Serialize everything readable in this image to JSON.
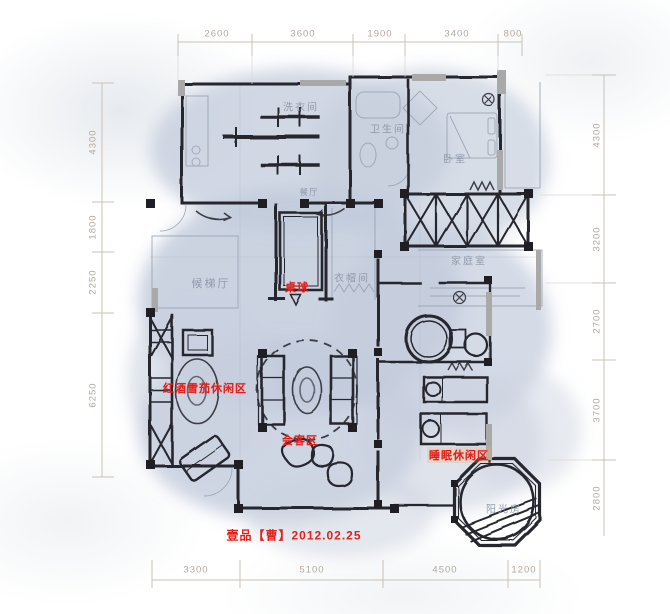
{
  "document": {
    "type": "hand-drawn interior floor plan sketch",
    "watermark": "壹品【曹】2012.02.25"
  },
  "dimensions": {
    "top": [
      "2600",
      "3600",
      "1900",
      "3400",
      "800"
    ],
    "bottom": [
      "3300",
      "5100",
      "4500",
      "1200"
    ],
    "left": [
      "4300",
      "1800",
      "2250",
      "6250"
    ],
    "right": [
      "4300",
      "3200",
      "2700",
      "3700",
      "2800"
    ]
  },
  "rooms": {
    "laundry": "洗衣间",
    "bathroom": "卫生间",
    "bedroom": "卧室",
    "dining": "餐厅",
    "family_room": "家庭室",
    "cloakroom": "衣帽间",
    "elevator_hall": "候梯厅",
    "sunroom": "阳光房"
  },
  "zones": {
    "billiards": "桌球",
    "wine_cigar_lounge": "红酒雪茄休闲区",
    "reception": "会客区",
    "sleep_lounge": "睡眠休闲区"
  },
  "colors": {
    "accent_red": "#e3201b",
    "wash_blue": "#c6cedd",
    "wall_ink": "#26262e",
    "dimension_text": "#b3a89e",
    "room_label_gray": "#8d96a7"
  }
}
